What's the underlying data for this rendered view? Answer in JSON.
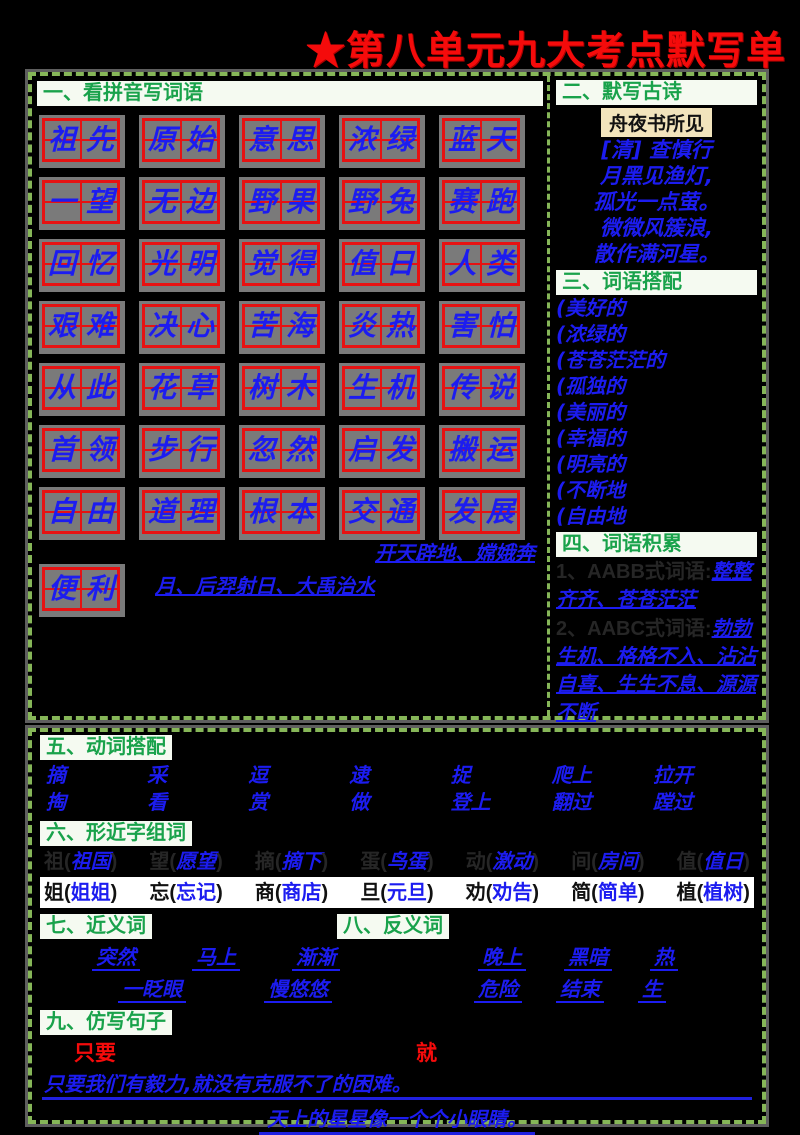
{
  "title": "★第八单元九大考点默写单",
  "colors": {
    "accent_red": "#f50b0b",
    "grid_red": "#e61212",
    "handwriting_blue": "#1c1cf0",
    "header_green": "#19a24b",
    "border_green": "#86b658"
  },
  "section1": {
    "heading": "一、看拼音写词语",
    "row1": [
      "祖先",
      "原始",
      "意思",
      "浓绿",
      "蓝天"
    ],
    "row2": [
      "一望",
      "无边",
      "野果",
      "野兔",
      "赛跑"
    ],
    "row3": [
      "回忆",
      "光明",
      "觉得",
      "值日",
      "人类"
    ],
    "row4": [
      "艰难",
      "决心",
      "苦海",
      "炎热",
      "害怕"
    ],
    "row5": [
      "从此",
      "花草",
      "树木",
      "生机",
      "传说"
    ],
    "row6": [
      "首领",
      "步行",
      "忽然",
      "启发",
      "搬运"
    ],
    "row7": [
      "自由",
      "道理",
      "根本",
      "交通",
      "发展"
    ],
    "row8": [
      "便利"
    ],
    "legend_line1": "开天辟地、嫦娥奔",
    "legend_line2": "月、后羿射日、大禹治水"
  },
  "section2": {
    "heading": "二、默写古诗",
    "poem_title": "舟夜书所见",
    "author": "[清] 查慎行",
    "lines": [
      "月黑见渔灯,",
      "孤光一点萤。",
      "微微风簇浪,",
      "散作满河星。"
    ]
  },
  "section3": {
    "heading": "三、词语搭配",
    "items": [
      "(美好的",
      "(浓绿的",
      "(苍苍茫茫的",
      "(孤独的",
      "(美丽的",
      "(幸福的",
      "(明亮的",
      "(不断地",
      "(自由地"
    ]
  },
  "section4": {
    "heading": "四、词语积累",
    "item1_prompt": "1、AABB式词语:",
    "item1_answer": "整整齐齐、苍苍茫茫",
    "item2_prompt": "2、AABC式词语:",
    "item2_answer": "勃勃生机、格格不入、沾沾自喜、生生不息、源源不断"
  },
  "section5": {
    "heading": "五、动词搭配",
    "row1": [
      "摘",
      "采",
      "逗",
      "逮",
      "捉",
      "爬上",
      "拉开"
    ],
    "row2": [
      "掏",
      "看",
      "赏",
      "做",
      "登上",
      "翻过",
      "蹚过"
    ]
  },
  "section6": {
    "heading": "六、形近字组词",
    "row1": [
      {
        "prompt": "祖(",
        "answer": "祖国",
        "suffix": ")"
      },
      {
        "prompt": "望(",
        "answer": "愿望",
        "suffix": ")"
      },
      {
        "prompt": "摘(",
        "answer": "摘下",
        "suffix": ")"
      },
      {
        "prompt": "蛋(",
        "answer": "鸟蛋",
        "suffix": ")"
      },
      {
        "prompt": "动(",
        "answer": "激动",
        "suffix": ")"
      },
      {
        "prompt": "间(",
        "answer": "房间",
        "suffix": ")"
      },
      {
        "prompt": "值(",
        "answer": "值日",
        "suffix": ")"
      }
    ],
    "row2": [
      {
        "prompt": "姐(",
        "answer": "姐姐",
        "suffix": ")"
      },
      {
        "prompt": "忘(",
        "answer": "忘记",
        "suffix": ")"
      },
      {
        "prompt": "商(",
        "answer": "商店",
        "suffix": ")"
      },
      {
        "prompt": "旦(",
        "answer": "元旦",
        "suffix": ")"
      },
      {
        "prompt": "劝(",
        "answer": "劝告",
        "suffix": ")"
      },
      {
        "prompt": "简(",
        "answer": "简单",
        "suffix": ")"
      },
      {
        "prompt": "植(",
        "answer": "植树",
        "suffix": ")"
      }
    ]
  },
  "section7": {
    "heading": "七、近义词",
    "row1": [
      "突然",
      "马上",
      "渐渐"
    ],
    "row2": [
      "一眨眼",
      "慢悠悠"
    ]
  },
  "section8": {
    "heading": "八、反义词",
    "row1": [
      "晚上",
      "黑暗",
      "热"
    ],
    "row2": [
      "危险",
      "结束",
      "生"
    ]
  },
  "section9": {
    "heading": "九、仿写句子",
    "red_word1": "只要",
    "red_word2": "就",
    "answer1": "只要我们有毅力,就没有克服不了的困难。",
    "answer2": "天上的星星像一个个小眼睛。"
  }
}
